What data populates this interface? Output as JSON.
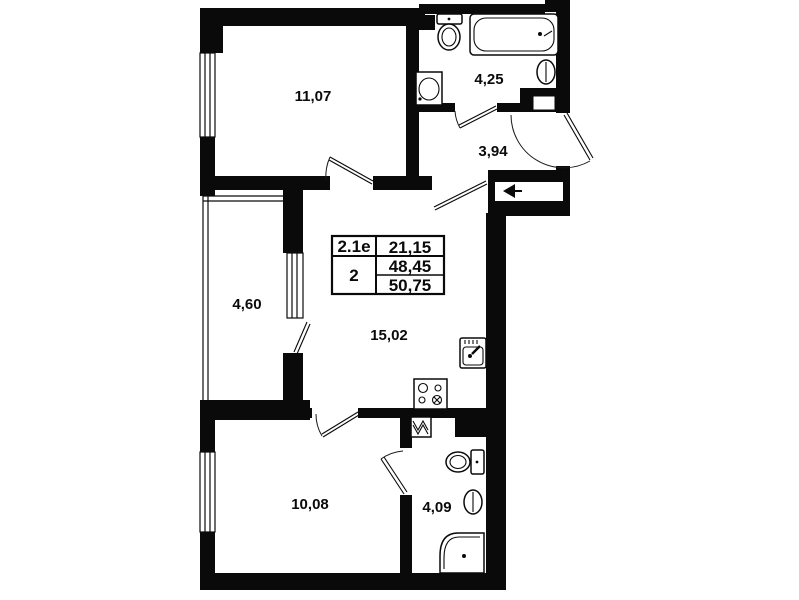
{
  "plan": {
    "title": "apartment-floor-plan",
    "rooms": [
      {
        "id": "room-top-left",
        "type": "living-room",
        "label": "11,07"
      },
      {
        "id": "bathroom-top",
        "type": "bathroom",
        "label": "4,25"
      },
      {
        "id": "hallway",
        "type": "hallway",
        "label": "3,94"
      },
      {
        "id": "balcony",
        "type": "balcony",
        "label": "4,60"
      },
      {
        "id": "kitchen-living",
        "type": "kitchen-living-room",
        "label": "15,02"
      },
      {
        "id": "room-bottom-left",
        "type": "bedroom",
        "label": "10,08"
      },
      {
        "id": "bathroom-bottom",
        "type": "bathroom",
        "label": "4,09"
      }
    ],
    "info_table": {
      "type_code": "2.1е",
      "living_area": "21,15",
      "rooms_count": "2",
      "area_no_balcony": "48,45",
      "total_area": "50,75"
    },
    "fixtures": [
      "bathtub",
      "toilet",
      "washbasin",
      "wall-sink",
      "kitchen-sink",
      "stove",
      "washing-machine",
      "shower",
      "entry-arrow"
    ],
    "colors": {
      "wall": "#0a0a0a",
      "background": "#ffffff"
    }
  }
}
